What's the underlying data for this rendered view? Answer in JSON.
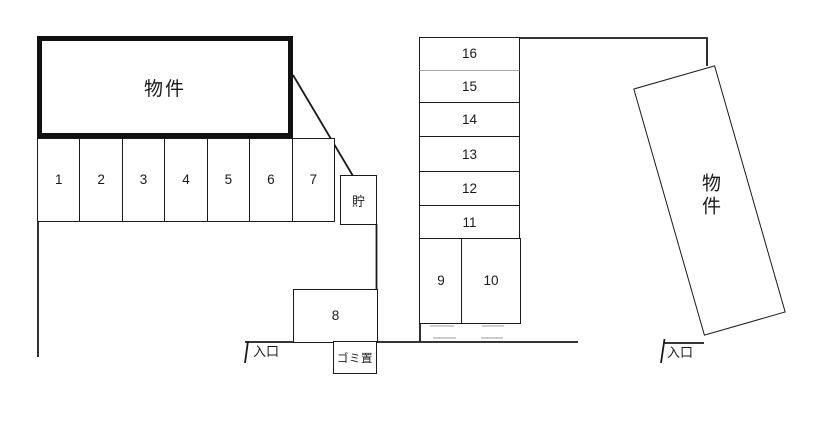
{
  "plan": {
    "colors": {
      "line": "#1a1a1a",
      "thick_building_border": "#111111",
      "gray_divider": "#a8a8a8",
      "background": "#ffffff"
    },
    "building_left": {
      "label": "物件"
    },
    "building_right": {
      "label": "物件"
    },
    "storage": {
      "label": "貯"
    },
    "garbage": {
      "label": "ゴミ置"
    },
    "entrance_left": {
      "label": "入口"
    },
    "entrance_right": {
      "label": "入口"
    },
    "parking_row": [
      "1",
      "2",
      "3",
      "4",
      "5",
      "6",
      "7"
    ],
    "parking_column": [
      "16",
      "15",
      "14",
      "13",
      "12",
      "11"
    ],
    "parking_pair": [
      "9",
      "10"
    ],
    "parking_single": {
      "label": "8"
    }
  }
}
